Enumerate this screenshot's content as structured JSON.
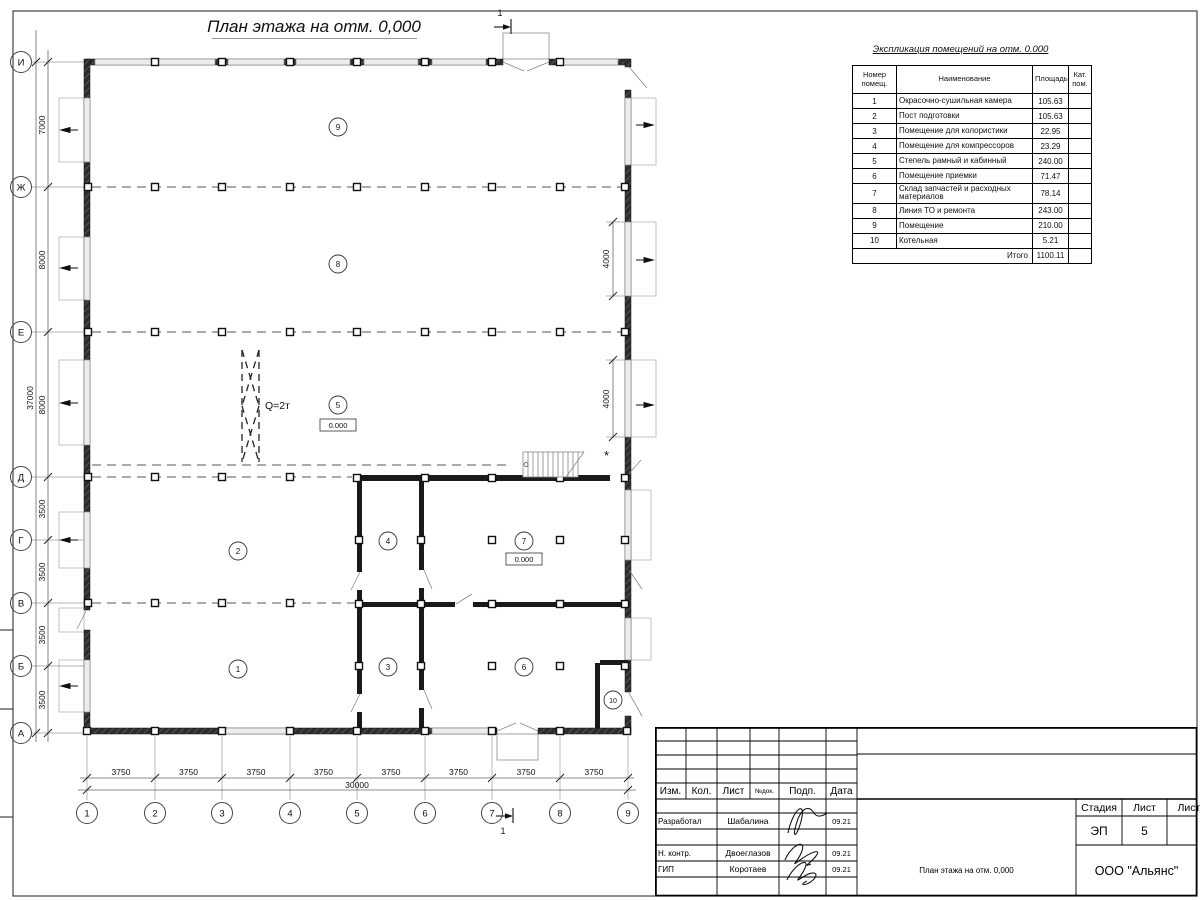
{
  "plan": {
    "title": "План этажа на отм. 0,000",
    "section_mark": "1",
    "asterisk": "*",
    "level_mark": "0.000",
    "crane_label": "Q=2т",
    "row_axes": [
      "И",
      "Ж",
      "Е",
      "Д",
      "Г",
      "В",
      "Б",
      "А"
    ],
    "col_axes": [
      "1",
      "2",
      "3",
      "4",
      "5",
      "6",
      "7",
      "8",
      "9"
    ],
    "dims_left": [
      "7000",
      "8000",
      "8000",
      "3500",
      "3500",
      "3500",
      "3500"
    ],
    "dim_left_total": "37000",
    "dims_bottom": [
      "3750",
      "3750",
      "3750",
      "3750",
      "3750",
      "3750",
      "3750",
      "3750"
    ],
    "dim_bottom_total": "30000",
    "dims_right": [
      "4000",
      "4000"
    ],
    "rooms": [
      "1",
      "2",
      "3",
      "4",
      "5",
      "6",
      "7",
      "8",
      "9",
      "10"
    ]
  },
  "explication": {
    "title": "Экспликация помещений на отм. 0.000",
    "col_headers": [
      "Номер помещ.",
      "Наименование",
      "Площадь",
      "Кат. пом."
    ],
    "rows": [
      {
        "num": "1",
        "name": "Окрасочно-сушильная камера",
        "area": "105.63",
        "kat": ""
      },
      {
        "num": "2",
        "name": "Пост подготовки",
        "area": "105.63",
        "kat": ""
      },
      {
        "num": "3",
        "name": "Помещение для колористики",
        "area": "22.95",
        "kat": ""
      },
      {
        "num": "4",
        "name": "Помещение для компрессоров",
        "area": "23.29",
        "kat": ""
      },
      {
        "num": "5",
        "name": "Степель рамный и кабинный",
        "area": "240.00",
        "kat": ""
      },
      {
        "num": "6",
        "name": "Помещение приемки",
        "area": "71.47",
        "kat": ""
      },
      {
        "num": "7",
        "name": "Склад запчастей и расходных материалов",
        "area": "78.14",
        "kat": ""
      },
      {
        "num": "8",
        "name": "Линия ТО и ремонта",
        "area": "243.00",
        "kat": ""
      },
      {
        "num": "9",
        "name": "Помещение",
        "area": "210.00",
        "kat": ""
      },
      {
        "num": "10",
        "name": "Котельная",
        "area": "5.21",
        "kat": ""
      }
    ],
    "total_label": "Итого",
    "total_value": "1100.11"
  },
  "title_block": {
    "headers": {
      "izm": "Изм.",
      "kol": "Кол.",
      "list": "Лист",
      "ndoc": "№док.",
      "podp": "Подп.",
      "data": "Дата"
    },
    "roles": [
      {
        "role": "Разработал",
        "name": "Шабалина",
        "date": "09.21"
      },
      {
        "role": "Н. контр.",
        "name": "Двоеглазов",
        "date": "09.21"
      },
      {
        "role": "ГИП",
        "name": "Коротаев",
        "date": "09.21"
      }
    ],
    "stage_label": "Стадия",
    "sheet_label": "Лист",
    "sheets_label": "Листов",
    "stage_value": "ЭП",
    "sheet_value": "5",
    "doc_title": "План этажа на отм. 0,000",
    "company": "ООО \"Альянс\""
  }
}
